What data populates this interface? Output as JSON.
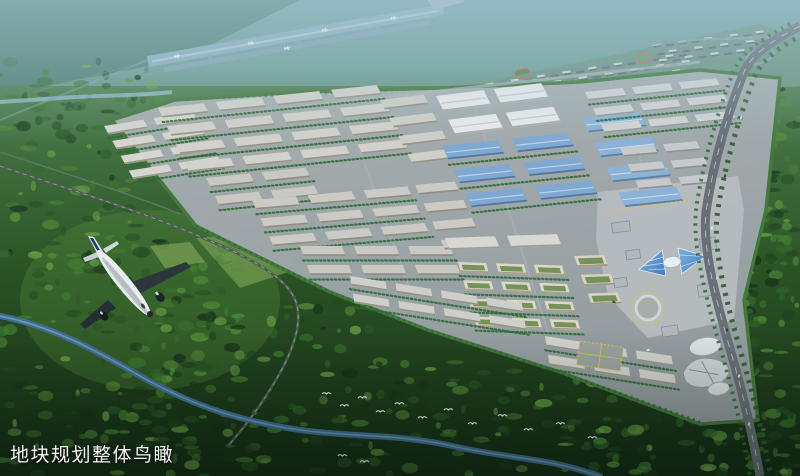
{
  "caption": {
    "text": "地块规划整体鸟瞰"
  },
  "palette": {
    "haze_top": "#7aa3ae",
    "distant_green": "#577f63",
    "runway": "#8cadc0",
    "park_road": "#9aa3a7",
    "warehouse_roof": "#cdccc6",
    "white_factory_roof": "#e7e9ea",
    "blue_factory_roof": "#7fa9d2",
    "courtyard_roof": "#ddd7c7",
    "civic_glass_blue": "#4f8fd0",
    "accent_yellow": "#e2c24e",
    "forest_dark": "#1d421f",
    "river_blue": "#3f6f94",
    "airplane_white": "#e9edee",
    "caption_color": "#f5f5f5"
  },
  "scene": {
    "forest_palette": [
      "#16301a",
      "#1d421f",
      "#275426",
      "#336a2b",
      "#417f30",
      "#548f3a",
      "#6aa348"
    ],
    "forest_regions": [
      {
        "x": 0,
        "y": 96,
        "w": 140,
        "h": 170,
        "count": 70
      },
      {
        "x": 0,
        "y": 240,
        "w": 240,
        "h": 236,
        "count": 150
      },
      {
        "x": 150,
        "y": 300,
        "w": 220,
        "h": 176,
        "count": 110
      },
      {
        "x": 360,
        "y": 360,
        "w": 260,
        "h": 116,
        "count": 110
      },
      {
        "x": 600,
        "y": 420,
        "w": 200,
        "h": 56,
        "count": 60
      },
      {
        "x": 755,
        "y": 86,
        "w": 45,
        "h": 180,
        "count": 55
      },
      {
        "x": 735,
        "y": 270,
        "w": 65,
        "h": 206,
        "count": 70
      },
      {
        "x": 0,
        "y": 60,
        "w": 160,
        "h": 50,
        "count": 30
      }
    ],
    "zones": [
      {
        "id": "west-tip",
        "x": 104,
        "y": 126,
        "rot": -9,
        "skew": 20,
        "cols": 2,
        "rows": 4,
        "bw": 40,
        "bh": 9,
        "gx": 10,
        "gy": 7,
        "roof": "#d6d5cf",
        "shade": "#9b998f",
        "trees": true
      },
      {
        "id": "nw-block",
        "x": 158,
        "y": 108,
        "rot": -6,
        "skew": 20,
        "cols": 4,
        "rows": 4,
        "bw": 46,
        "bh": 10,
        "gx": 12,
        "gy": 9,
        "roof": "#d2d1cb",
        "shade": "#98958c",
        "trees": true
      },
      {
        "id": "w-block-a",
        "x": 206,
        "y": 178,
        "rot": -6,
        "skew": 20,
        "cols": 2,
        "rows": 2,
        "bw": 44,
        "bh": 10,
        "gx": 12,
        "gy": 9,
        "roof": "#c9c8c2",
        "shade": "#908e85",
        "trees": true
      },
      {
        "id": "w-block-b",
        "x": 252,
        "y": 200,
        "rot": -5,
        "skew": 20,
        "cols": 3,
        "rows": 3,
        "bw": 44,
        "bh": 10,
        "gx": 12,
        "gy": 9,
        "roof": "#cbcac4",
        "shade": "#918e85",
        "trees": true
      },
      {
        "id": "w-block-c",
        "x": 300,
        "y": 246,
        "rot": 0,
        "skew": 20,
        "cols": 3,
        "rows": 2,
        "bw": 42,
        "bh": 10,
        "gx": 12,
        "gy": 9,
        "roof": "#c9c8c2",
        "shade": "#908e85",
        "trees": true
      },
      {
        "id": "m1",
        "x": 380,
        "y": 100,
        "rot": -7,
        "skew": 20,
        "cols": 1,
        "rows": 4,
        "bw": 44,
        "bh": 10,
        "gx": 10,
        "gy": 9,
        "roof": "#cfcec8",
        "shade": "#979489",
        "trees": false
      },
      {
        "id": "n-sheds",
        "x": 436,
        "y": 96,
        "rot": -7,
        "skew": 20,
        "cols": 2,
        "rows": 2,
        "bw": 48,
        "bh": 16,
        "gx": 10,
        "gy": 9,
        "roof": "#e7e9ea",
        "shade": "#a9adaf",
        "ridge": "#c3c9cc",
        "trees": false
      },
      {
        "id": "blue-a",
        "x": 442,
        "y": 146,
        "rot": -6,
        "skew": 20,
        "cols": 2,
        "rows": 3,
        "bw": 56,
        "bh": 14,
        "gx": 14,
        "gy": 11,
        "roof": "#7fa9d2",
        "shade": "#56779b",
        "ridge": "#b9d2ea",
        "trees": true
      },
      {
        "id": "blue-b",
        "x": 582,
        "y": 118,
        "rot": -6,
        "skew": 20,
        "cols": 1,
        "rows": 4,
        "bw": 58,
        "bh": 15,
        "gx": 12,
        "gy": 11,
        "roof": "#8cb2d8",
        "shade": "#5d80a5",
        "ridge": "#c2d8ee",
        "trees": false
      },
      {
        "id": "m2",
        "x": 415,
        "y": 185,
        "rot": -5,
        "skew": 20,
        "cols": 1,
        "rows": 4,
        "bw": 40,
        "bh": 10,
        "gx": 10,
        "gy": 9,
        "roof": "#cbcac4",
        "shade": "#918e85",
        "trees": false
      },
      {
        "id": "g1",
        "x": 445,
        "y": 238,
        "rot": -2,
        "skew": 20,
        "cols": 2,
        "rows": 1,
        "bw": 50,
        "bh": 12,
        "gx": 12,
        "gy": 9,
        "roof": "#d8d8d3",
        "shade": "#a09d93",
        "trees": false
      },
      {
        "id": "courtyards",
        "x": 458,
        "y": 262,
        "rot": 2,
        "skew": 18,
        "cols": 3,
        "rows": 4,
        "bw": 28,
        "bh": 10,
        "gx": 10,
        "gy": 8,
        "roof": "#ddd7c7",
        "shade": "#a89f8a",
        "court": "#74925a",
        "trees": true
      },
      {
        "id": "courtyards-e",
        "x": 574,
        "y": 256,
        "rot": -2,
        "skew": 18,
        "cols": 1,
        "rows": 3,
        "bw": 30,
        "bh": 11,
        "gx": 10,
        "gy": 8,
        "roof": "#d9d3c4",
        "shade": "#a39a86",
        "court": "#74925a",
        "trees": false
      },
      {
        "id": "e1",
        "x": 585,
        "y": 92,
        "rot": -6,
        "skew": 20,
        "cols": 3,
        "rows": 3,
        "bw": 38,
        "bh": 9,
        "gx": 9,
        "gy": 8,
        "roof": "#d0d2d2",
        "shade": "#969a9b",
        "trees": true
      },
      {
        "id": "e2",
        "x": 620,
        "y": 148,
        "rot": -5,
        "skew": 20,
        "cols": 2,
        "rows": 3,
        "bw": 34,
        "bh": 9,
        "gx": 9,
        "gy": 8,
        "roof": "#c6cacc",
        "shade": "#8e9395",
        "trees": false
      },
      {
        "id": "s-band-1",
        "x": 350,
        "y": 276,
        "rot": 9,
        "skew": 18,
        "cols": 4,
        "rows": 2,
        "bw": 36,
        "bh": 9,
        "gx": 10,
        "gy": 8,
        "roof": "#cfcfca",
        "shade": "#94928a",
        "trees": true
      },
      {
        "id": "s-band-2",
        "x": 545,
        "y": 336,
        "rot": 9,
        "skew": 18,
        "cols": 3,
        "rows": 2,
        "bw": 36,
        "bh": 10,
        "gx": 10,
        "gy": 8,
        "roof": "#d3d3ce",
        "shade": "#99968d",
        "trees": true
      },
      {
        "id": "resi-a",
        "x": 408,
        "y": 96,
        "rot": -9,
        "skew": 16,
        "cols": 22,
        "rows": 4,
        "bw": 8,
        "bh": 4,
        "gx": 5,
        "gy": 4,
        "roof": "#d9dfe2",
        "roof2": "#5f6d74",
        "alt": true,
        "shade": "#3f4a50",
        "layer": "resi"
      },
      {
        "id": "resi-b",
        "x": 652,
        "y": 44,
        "rot": -7,
        "skew": 16,
        "cols": 9,
        "rows": 3,
        "bw": 8,
        "bh": 4,
        "gx": 5,
        "gy": 4,
        "roof": "#d5dbde",
        "roof2": "#64727a",
        "alt": true,
        "shade": "#3f4a50",
        "layer": "resi"
      }
    ],
    "birds": [
      [
        322,
        394
      ],
      [
        340,
        406
      ],
      [
        358,
        398
      ],
      [
        376,
        412
      ],
      [
        395,
        404
      ],
      [
        418,
        418
      ],
      [
        444,
        410
      ],
      [
        468,
        424
      ],
      [
        498,
        416
      ],
      [
        524,
        430
      ],
      [
        556,
        424
      ],
      [
        588,
        438
      ],
      [
        338,
        456
      ],
      [
        360,
        462
      ]
    ],
    "cars": [
      [
        741,
        118,
        -78,
        "#e8ecee"
      ],
      [
        725,
        176,
        -80,
        "#2e3a42"
      ],
      [
        712,
        228,
        -82,
        "#e8ecee"
      ],
      [
        717,
        278,
        -75,
        "#cfd6da"
      ],
      [
        727,
        330,
        -72,
        "#2e3a42"
      ],
      [
        739,
        376,
        -70,
        "#e8ecee"
      ],
      [
        749,
        424,
        -68,
        "#d7dde0"
      ],
      [
        648,
        350,
        -15,
        "#e8ecee"
      ],
      [
        614,
        302,
        15,
        "#2e3a42"
      ]
    ],
    "runway_planes": [
      [
        30,
        0
      ],
      [
        105,
        0
      ],
      [
        180,
        0
      ],
      [
        250,
        0
      ],
      [
        140,
        1
      ]
    ]
  }
}
